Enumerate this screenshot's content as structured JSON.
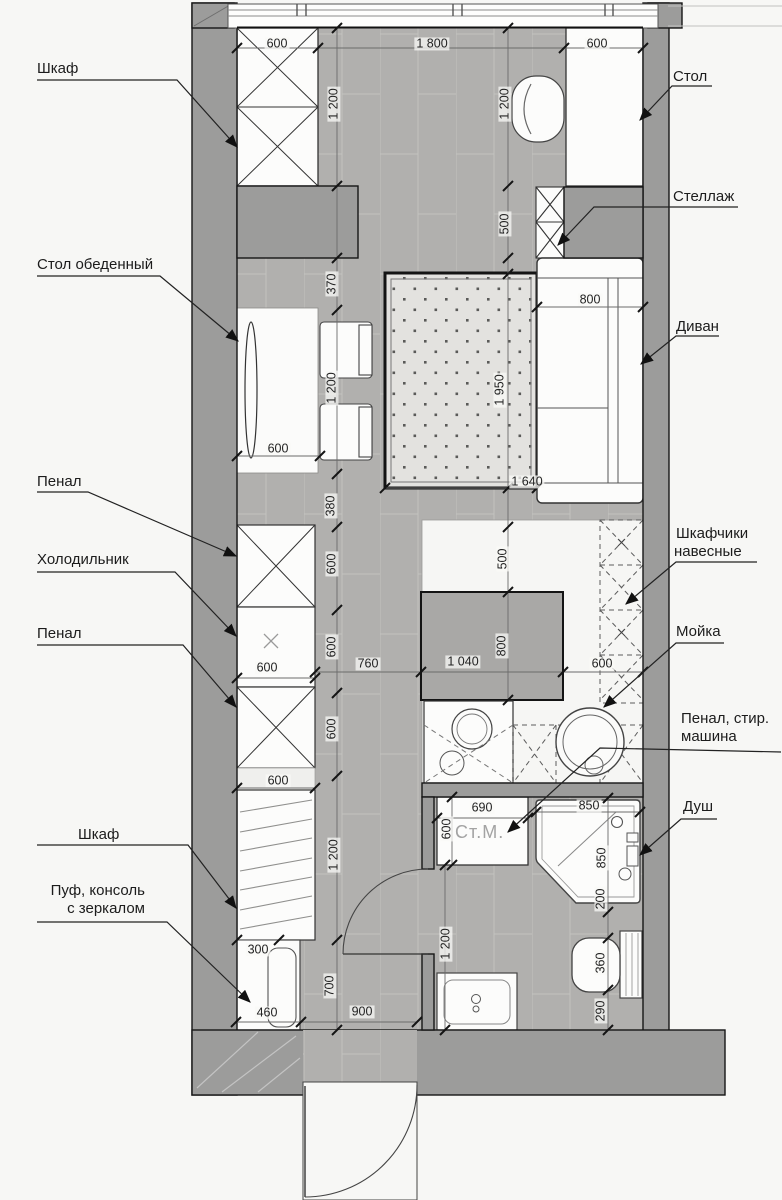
{
  "plan": {
    "title": "studio apartment furniture floor plan",
    "labels": {
      "wardrobe_top": "Шкаф",
      "desk": "Стол",
      "shelving": "Стеллаж",
      "dining_table": "Стол обеденный",
      "sofa": "Диван",
      "tall_cabinet_1": "Пенал",
      "fridge": "Холодильник",
      "tall_cabinet_2": "Пенал",
      "wall_cabinets_line1": "Шкафчики",
      "wall_cabinets_line2": "навесные",
      "kitchen_sink": "Мойка",
      "cabinet_washer_line1": "Пенал, стир.",
      "cabinet_washer_line2": "машина",
      "wardrobe_bottom": "Шкаф",
      "pouf_console_line1": "Пуф, консоль",
      "pouf_console_line2": "с зеркалом",
      "shower": "Душ",
      "washing_machine_abbr": "Ст.М."
    },
    "dims": [
      "600",
      "1 800",
      "600",
      "1 200",
      "1 200",
      "500",
      "370",
      "800",
      "1 950",
      "1 200",
      "600",
      "1 640",
      "380",
      "500",
      "600",
      "600",
      "600",
      "760",
      "1 040",
      "800",
      "600",
      "600",
      "600",
      "1 200",
      "300",
      "700",
      "460",
      "900",
      "690",
      "600",
      "850",
      "850",
      "200",
      "1 200",
      "360",
      "290"
    ],
    "colors": {
      "wall": "#9c9c9b",
      "floor": "#b1b0ae",
      "rug": "#e3e2df",
      "furniture": "#fcfcfb"
    }
  }
}
